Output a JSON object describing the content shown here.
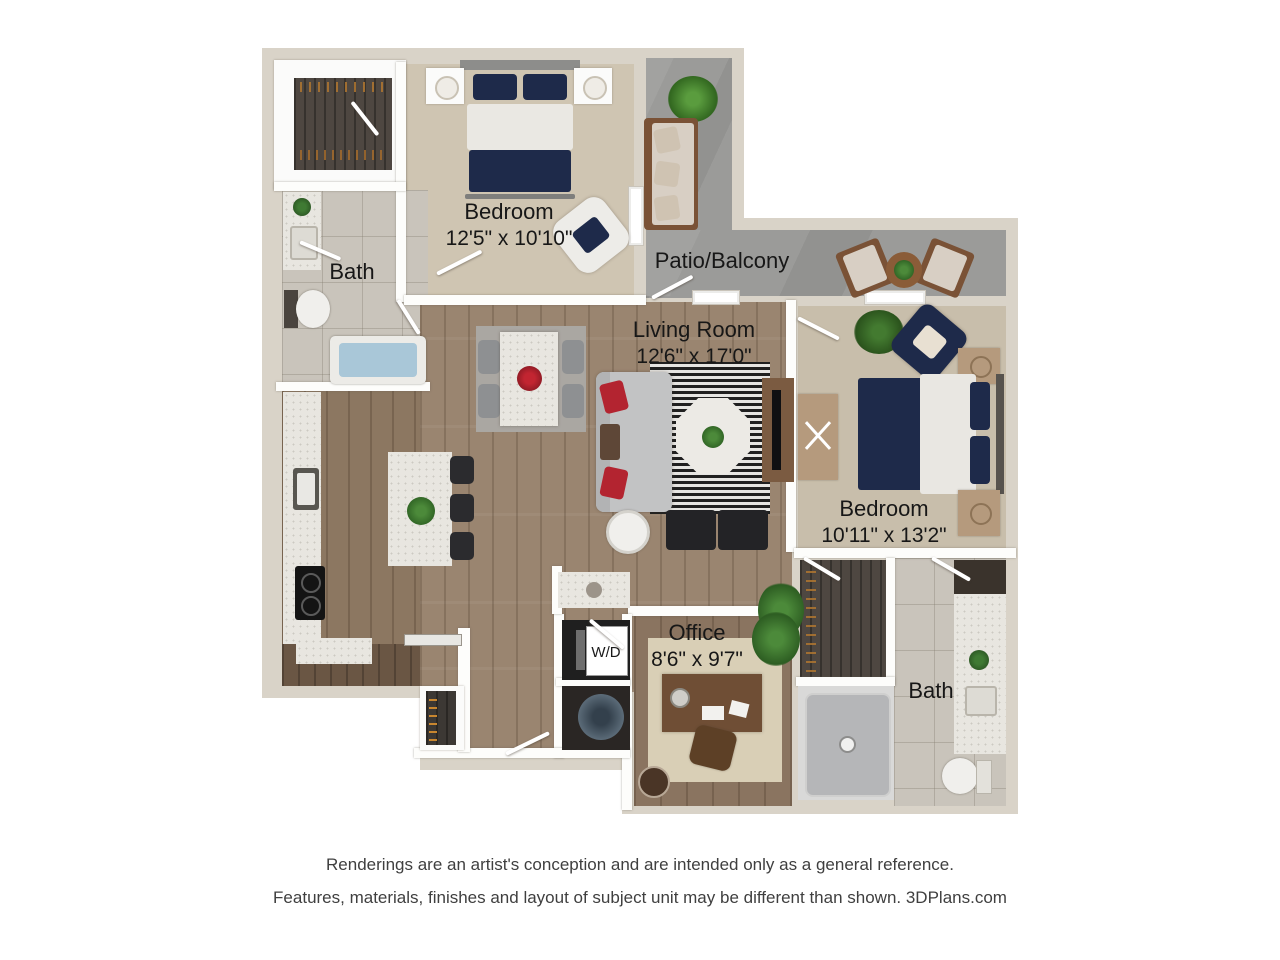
{
  "rooms": [
    {
      "id": "bedroom-1",
      "label": "Bedroom",
      "dims": "12'5\" x 10'10\""
    },
    {
      "id": "bath-1",
      "label": "Bath"
    },
    {
      "id": "patio",
      "label": "Patio/Balcony"
    },
    {
      "id": "living-room",
      "label": "Living Room",
      "dims": "12'6\" x 17'0\""
    },
    {
      "id": "bedroom-2",
      "label": "Bedroom",
      "dims": "10'11\" x 13'2\""
    },
    {
      "id": "office",
      "label": "Office",
      "dims": "8'6\" x 9'7\""
    },
    {
      "id": "bath-2",
      "label": "Bath"
    },
    {
      "id": "laundry",
      "label": "W/D"
    }
  ],
  "disclaimer": {
    "line1": "Renderings are an artist's conception and are intended only as a general reference.",
    "line2": "Features, materials, finishes and layout of subject unit may be different than shown. 3DPlans.com"
  },
  "colors": {
    "exterior_wall": "#d9d3c8",
    "patio_concrete": "#9b9b99",
    "wood_floor": "#9a8570",
    "carpet": "#cfc5b2",
    "tile": "#c9c4bb",
    "accent_navy": "#1e2a4a",
    "accent_red": "#b32430",
    "label_text": "#171717"
  }
}
